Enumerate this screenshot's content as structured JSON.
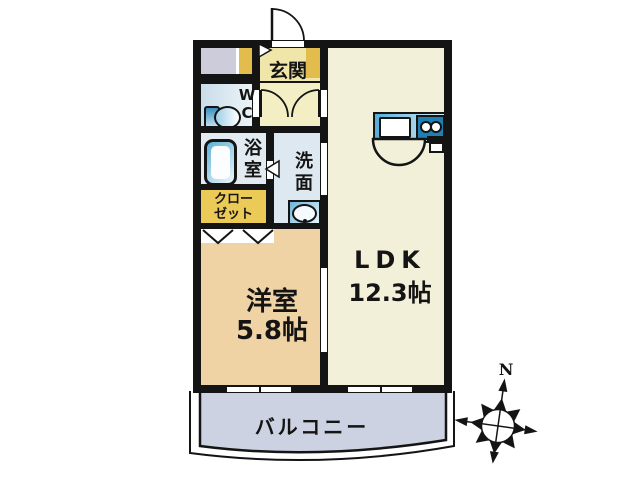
{
  "floorplan": {
    "title": "1LDK apartment floor plan",
    "rooms": {
      "entrance": {
        "label": "玄関"
      },
      "wc": {
        "line1": "W",
        "line2": "C"
      },
      "bath": {
        "line1": "浴",
        "line2": "室"
      },
      "washroom": {
        "line1": "洗",
        "line2": "面"
      },
      "closet": {
        "line1": "クロー",
        "line2": "ゼット"
      },
      "bedroom": {
        "label": "洋室",
        "size": "5.8帖"
      },
      "ldk": {
        "label": "LDK",
        "size": "12.3帖"
      },
      "balcony": {
        "label": "バルコニー"
      }
    },
    "compass": {
      "north": "N"
    },
    "colors": {
      "wall": "#141414",
      "ldk_floor": "#f2f0d9",
      "bedroom_floor": "#f0d3a5",
      "entrance_floor": "#f1e6a9",
      "hallway_floor": "#f4eec4",
      "cabinet_yellow": "#e2bd4e",
      "closet_yellow": "#ecca57",
      "balcony_gray": "#ccd2e2",
      "meter_box_gray": "#ccccda",
      "stove_blue": "#1f7fb3"
    }
  }
}
